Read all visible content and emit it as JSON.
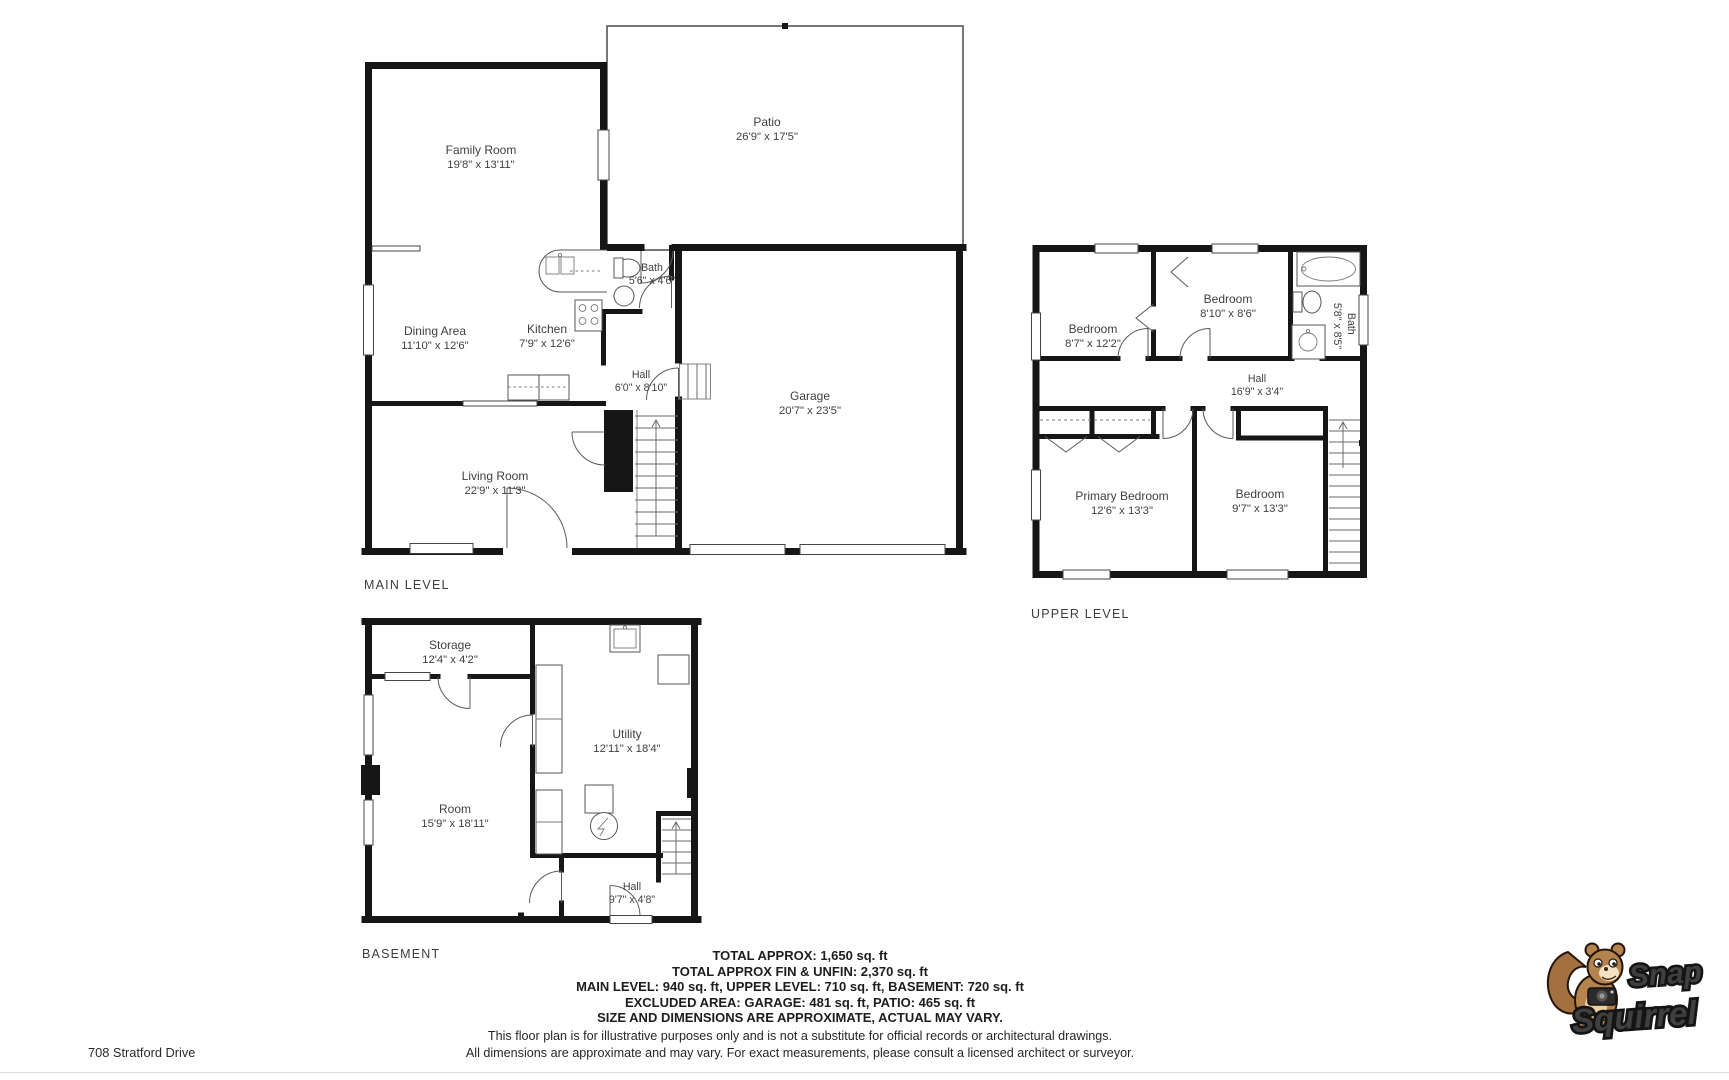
{
  "page": {
    "address": "708 Stratford Drive"
  },
  "levels": {
    "main": {
      "title": "MAIN LEVEL",
      "rooms": {
        "family": {
          "name": "Family Room",
          "dims": "19'8\" x 13'11\""
        },
        "patio": {
          "name": "Patio",
          "dims": "26'9\" x 17'5\""
        },
        "dining": {
          "name": "Dining Area",
          "dims": "11'10\" x 12'6\""
        },
        "kitchen": {
          "name": "Kitchen",
          "dims": "7'9\" x 12'6\""
        },
        "bath": {
          "name": "Bath",
          "dims": "5'6\" x 4'6\""
        },
        "hall": {
          "name": "Hall",
          "dims": "6'0\" x 8'10\""
        },
        "garage": {
          "name": "Garage",
          "dims": "20'7\" x 23'5\""
        },
        "living": {
          "name": "Living Room",
          "dims": "22'9\" x 11'3\""
        }
      }
    },
    "upper": {
      "title": "UPPER LEVEL",
      "rooms": {
        "bedroom1": {
          "name": "Bedroom",
          "dims": "8'7\" x 12'2\""
        },
        "bedroom2": {
          "name": "Bedroom",
          "dims": "8'10\" x 8'6\""
        },
        "bath": {
          "name": "Bath",
          "dims": "5'8\" x 8'5\""
        },
        "hall": {
          "name": "Hall",
          "dims": "16'9\" x 3'4\""
        },
        "primary": {
          "name": "Primary Bedroom",
          "dims": "12'6\" x 13'3\""
        },
        "bedroom3": {
          "name": "Bedroom",
          "dims": "9'7\" x 13'3\""
        }
      }
    },
    "basement": {
      "title": "BASEMENT",
      "rooms": {
        "storage": {
          "name": "Storage",
          "dims": "12'4\" x 4'2\""
        },
        "utility": {
          "name": "Utility",
          "dims": "12'11\" x 18'4\""
        },
        "room": {
          "name": "Room",
          "dims": "15'9\" x 18'11\""
        },
        "hall": {
          "name": "Hall",
          "dims": "9'7\" x 4'8\""
        }
      }
    }
  },
  "summary": {
    "line1": "TOTAL APPROX: 1,650 sq. ft",
    "line2": "TOTAL APPROX FIN & UNFIN: 2,370 sq. ft",
    "line3": "MAIN LEVEL: 940 sq. ft, UPPER LEVEL: 710 sq. ft, BASEMENT: 720 sq. ft",
    "line4": "EXCLUDED AREA: GARAGE: 481 sq. ft, PATIO: 465 sq. ft",
    "line5": "SIZE AND DIMENSIONS ARE APPROXIMATE, ACTUAL MAY VARY."
  },
  "disclaimer": {
    "line1": "This floor plan is for illustrative purposes only and is not a substitute for official records or architectural drawings.",
    "line2": "All dimensions are approximate and may vary. For exact measurements, please consult a licensed architect or surveyor."
  },
  "logo": {
    "word1": "Snap",
    "word2": "Squirrel",
    "colors": {
      "word1": "#a0a2a5",
      "word2": "#f29d1e",
      "outline": "#141414",
      "fur": "#b5834e"
    }
  }
}
